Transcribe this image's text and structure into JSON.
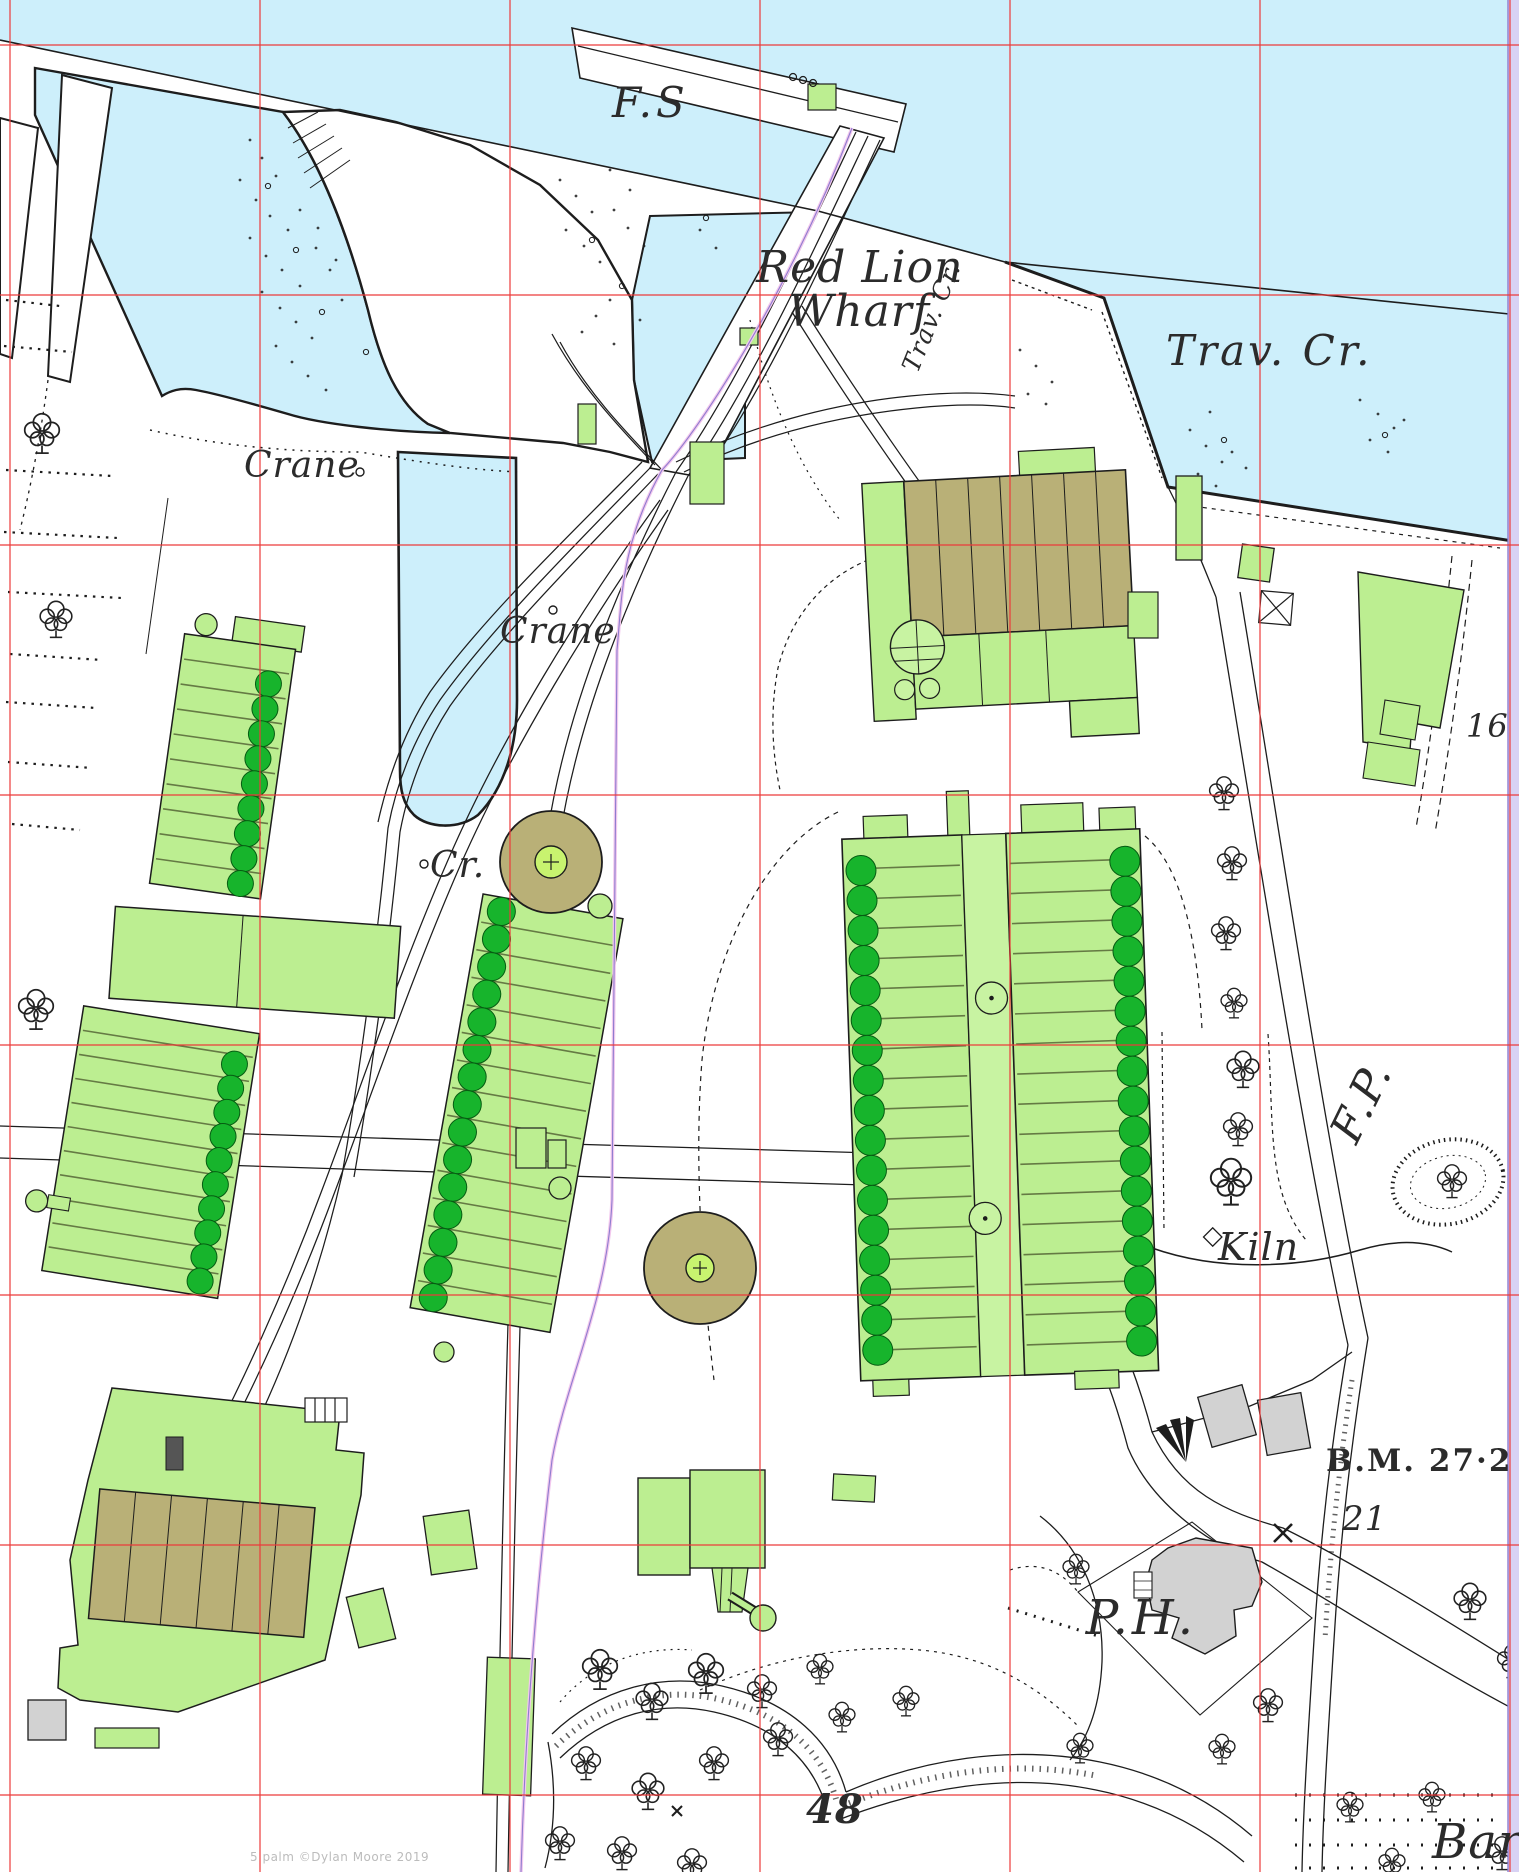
{
  "map": {
    "labels": {
      "fs": "F.S",
      "red_lion": "Red Lion",
      "wharf": "Wharf",
      "trav_cr_small": "Trav. Cr.",
      "trav_cr_large": "Trav. Cr.",
      "crane_upper": "Crane",
      "crane_lower": "Crane",
      "cr_abbrev": "Cr.",
      "parcel_16": "16",
      "footpath": "F.P.",
      "kiln": "Kiln",
      "benchmark": "B.M. 27·2",
      "parcel_21": "21",
      "public_house": "P.H.",
      "parcel_48": "48",
      "bard_partial": "Bard"
    },
    "watermark": "5 palm ©Dylan Moore 2019",
    "colors": {
      "water": "#cdeffb",
      "building_green": "#bcee91",
      "glasshouse_dark_green": "#17b42c",
      "tank_khaki": "#b9b077",
      "grey_building": "#d2d2d2",
      "grid_red": "#ec3b3b",
      "sheet_edge_lavender": "#d8d2f4",
      "tramway_purple": "#8f7ccf",
      "ink": "#1d1d1d"
    },
    "grid": {
      "x_lines": [
        10,
        260,
        510,
        760,
        1010,
        1260,
        1510
      ],
      "y_lines": [
        45,
        295,
        545,
        795,
        1045,
        1295,
        1545,
        1795
      ]
    }
  }
}
